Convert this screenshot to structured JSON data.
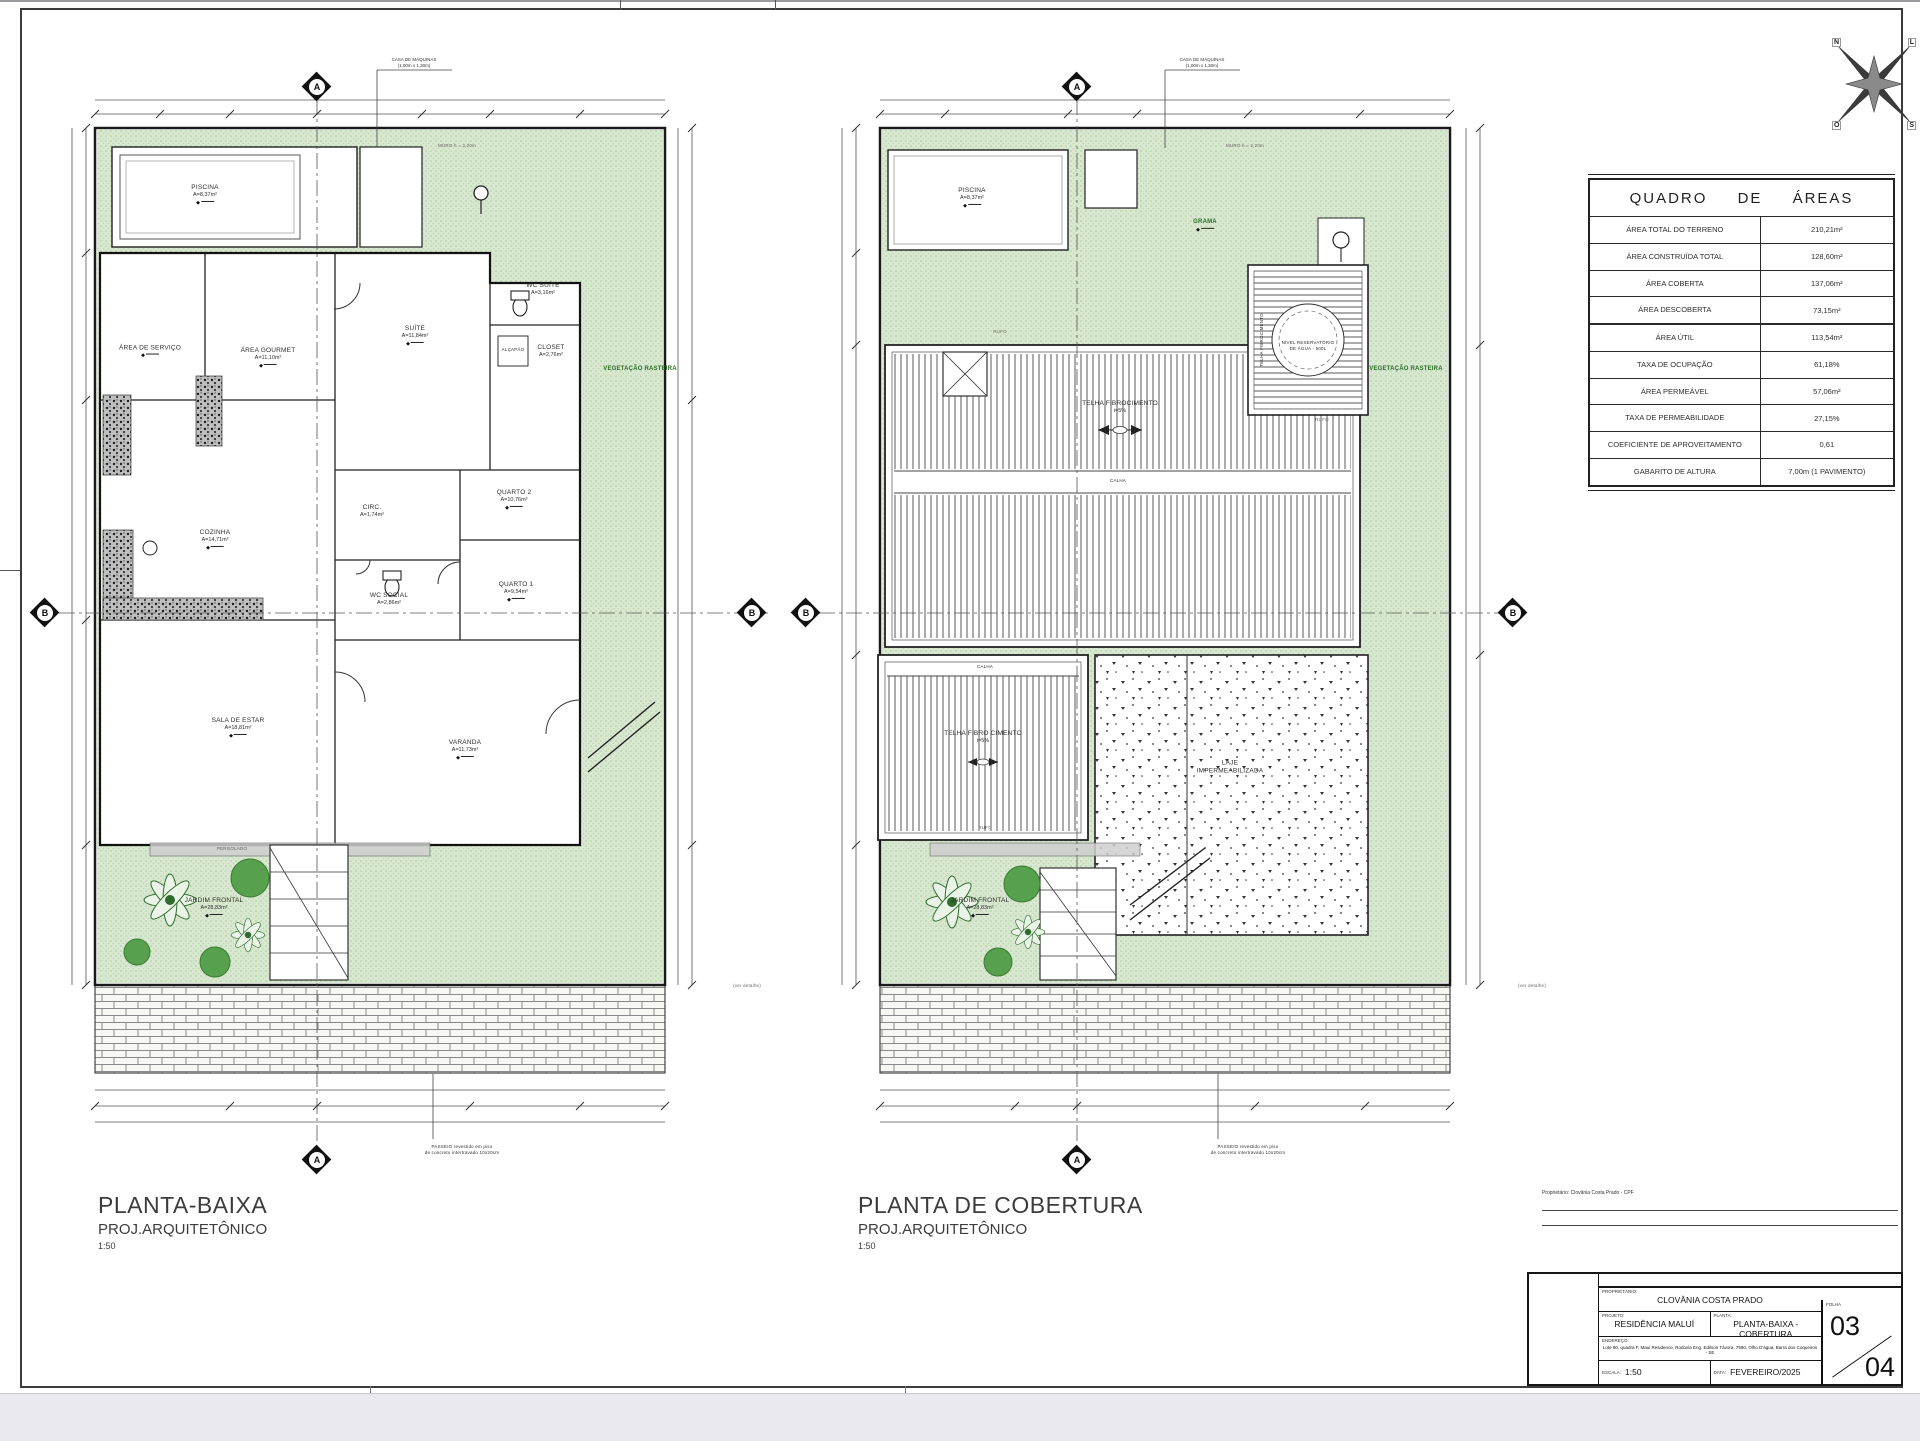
{
  "compass": {
    "n": "N",
    "e": "L",
    "s": "S",
    "w": "O"
  },
  "markers": {
    "a": "A",
    "b": "B"
  },
  "plan_titles": [
    {
      "title": "PLANTA-BAIXA",
      "subtitle": "PROJ.ARQUITETÔNICO",
      "scale": "1:50"
    },
    {
      "title": "PLANTA DE COBERTURA",
      "subtitle": "PROJ.ARQUITETÔNICO",
      "scale": "1:50"
    }
  ],
  "areas_table": {
    "title": "QUADRO DE ÁREAS",
    "rows": [
      {
        "label": "ÁREA TOTAL DO TERRENO",
        "value": "210,21m²"
      },
      {
        "label": "ÁREA CONSTRUÍDA TOTAL",
        "value": "128,60m²"
      },
      {
        "label": "ÁREA COBERTA",
        "value": "137,06m²"
      },
      {
        "label": "ÁREA DESCOBERTA",
        "value": "73,15m²"
      },
      {
        "label": "ÁREA ÚTIL",
        "value": "113,54m²"
      },
      {
        "label": "TAXA DE OCUPAÇÃO",
        "value": "61,18%"
      },
      {
        "label": "ÁREA PERMEÁVEL",
        "value": "57,06m²"
      },
      {
        "label": "TAXA DE PERMEABILIDADE",
        "value": "27,15%"
      },
      {
        "label": "COEFICIENTE DE APROVEITAMENTO",
        "value": "0,61"
      },
      {
        "label": "GABARITO DE ALTURA",
        "value": "7,00m (1 PAVIMENTO)"
      }
    ]
  },
  "plan1": {
    "rooms": [
      {
        "name": "PISCINA",
        "area": "A=8,37m²"
      },
      {
        "name": "ÁREA DE SERVIÇO",
        "area": ""
      },
      {
        "name": "ÁREA GOURMET",
        "area": "A=11,10m²"
      },
      {
        "name": "SUÍTE",
        "area": "A=11,84m²"
      },
      {
        "name": "WC SUÍTE",
        "area": "A=3,16m²"
      },
      {
        "name": "CLOSET",
        "area": "A=2,76m²"
      },
      {
        "name": "ALÇAPÃO",
        "area": ""
      },
      {
        "name": "QUARTO 2",
        "area": "A=10,76m²"
      },
      {
        "name": "CIRC.",
        "area": "A=1,74m²"
      },
      {
        "name": "COZINHA",
        "area": "A=14,71m²"
      },
      {
        "name": "QUARTO 1",
        "area": "A=9,54m²"
      },
      {
        "name": "WC SOCIAL",
        "area": "A=2,86m²"
      },
      {
        "name": "SALA DE ESTAR",
        "area": "A=18,81m²"
      },
      {
        "name": "VARANDA",
        "area": "A=11,73m²"
      },
      {
        "name": "JARDIM FRONTAL",
        "area": "A=28,83m²"
      },
      {
        "name": "VEGETAÇÃO RASTEIRA",
        "area": ""
      }
    ]
  },
  "plan2": {
    "labels": [
      {
        "name": "PISCINA",
        "area": "A=8,37m²"
      },
      {
        "name": "GRAMA",
        "area": ""
      },
      {
        "name": "TELHA FIBROCIMENTO",
        "area": "i=5%"
      },
      {
        "name": "CALHA",
        "area": ""
      },
      {
        "name": "NÍVEL RESERVATÓRIO",
        "area": "DE ÁGUA - 500L"
      },
      {
        "name": "TELHA FIBROCIMENTO",
        "area": ""
      },
      {
        "name": "CALHA",
        "area": ""
      },
      {
        "name": "TELHA FIBRO CIMENTO",
        "area": "i=5%"
      },
      {
        "name": "LAJE",
        "area": "IMPERMEABILIZADA"
      },
      {
        "name": "JARDIM FRONTAL",
        "area": "A=28,83m²"
      },
      {
        "name": "VEGETAÇÃO RASTEIRA",
        "area": ""
      },
      {
        "name": "RUFO",
        "area": ""
      },
      {
        "name": "RUFO",
        "area": ""
      },
      {
        "name": "RUFO",
        "area": ""
      }
    ]
  },
  "notes": {
    "casa_maquinas": "CASA DE MÁQUINAS",
    "casa_maquinas_dim": "(1,00m x 1,30m)",
    "muro": "MURO h = 2,20m",
    "pergolado": "PERGOLADO",
    "passeio_l1": "PASSEIO revestido em piso",
    "passeio_l2": "de concreto intertravado 10x20cm",
    "ver_detalhe": "(ver detalhe)",
    "level_icon": "◆"
  },
  "signature": {
    "note": "Proprietário: Clovânia Costa Prado - CPF"
  },
  "title_block": {
    "owner_label": "PROPRIETÁRIO:",
    "owner": "CLOVÂNIA COSTA PRADO",
    "project_label": "PROJETO:",
    "project": "RESIDÊNCIA MALUÍ",
    "plan_label": "PLANTA:",
    "plan": "PLANTA-BAIXA - COBERTURA",
    "address_label": "ENDEREÇO:",
    "address": "Lote 90, quadra F, Maui Residence, Rodovia Eng. Edilson Távora, 7580, Olho D'água, Barra dos Coqueiros - SE",
    "scale_label": "ESCALA:",
    "scale": "1:50",
    "date_label": "DATA:",
    "date": "FEVEREIRO/2025",
    "sheet_label": "FOLHA",
    "sheet_num": "03",
    "sheet_total": "04"
  }
}
